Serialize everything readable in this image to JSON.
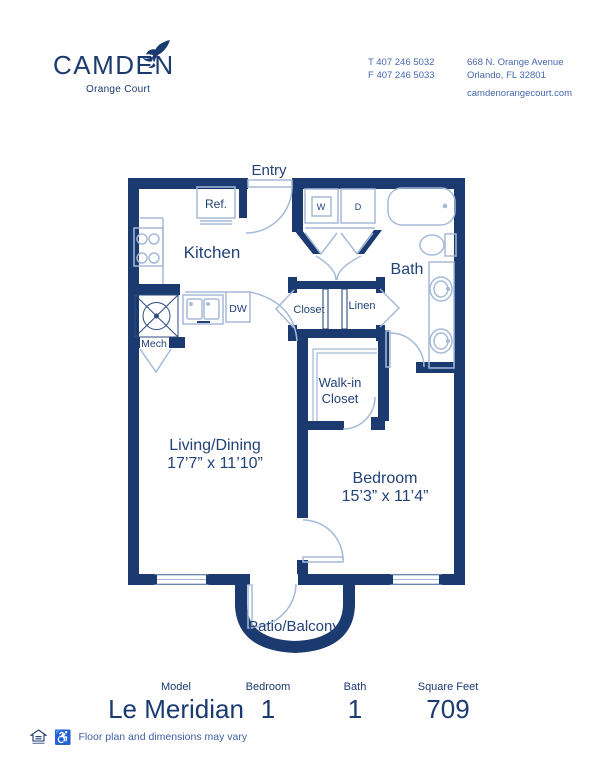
{
  "header": {
    "logo": {
      "name": "CAMDEN",
      "sub": "Orange Court"
    },
    "contact": {
      "phone1": "T 407 246 5032",
      "phone2": "F 407 246 5033",
      "address1": "668 N. Orange Avenue",
      "address2": "Orlando, FL 32801",
      "website": "camdenorangecourt.com"
    }
  },
  "floorplan": {
    "labels": {
      "entry": "Entry",
      "ref": "Ref.",
      "kitchen": "Kitchen",
      "washer": "W",
      "dryer": "D",
      "bath": "Bath",
      "mech": "Mech",
      "dishwasher": "DW",
      "closet": "Closet",
      "linen": "Linen",
      "walkin_line1": "Walk-in",
      "walkin_line2": "Closet",
      "living_line1": "Living/Dining",
      "living_line2": "17’7” x 11’10”",
      "bedroom_line1": "Bedroom",
      "bedroom_line2": "15’3” x 11’4”",
      "patio": "Patio/Balcony"
    }
  },
  "summary": {
    "columns": [
      {
        "label": "Model",
        "value": "Le Meridian"
      },
      {
        "label": "Bedroom",
        "value": "1"
      },
      {
        "label": "Bath",
        "value": "1"
      },
      {
        "label": "Square Feet",
        "value": "709"
      }
    ]
  },
  "footnote": {
    "text": "Floor plan and dimensions may vary"
  },
  "icons": {
    "accessibility": "♿"
  },
  "colors": {
    "navy": "#1b3a70",
    "medium_blue": "#4667ad",
    "light_blue": "#a5bad9"
  }
}
